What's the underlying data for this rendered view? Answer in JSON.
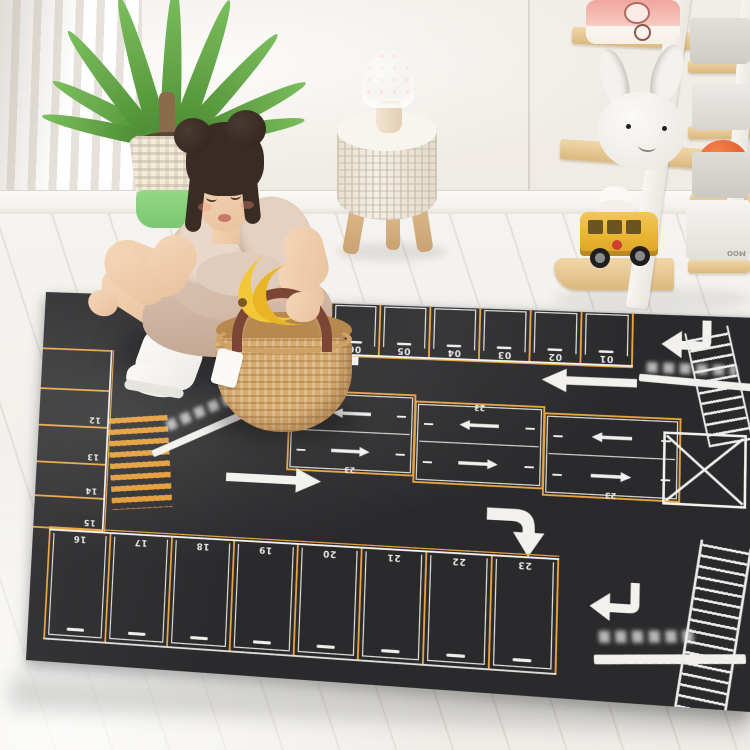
{
  "scene": {
    "mat": {
      "base_color": "#2a292b",
      "line_yellow": "#e8a33d",
      "line_white": "#f2f1ee",
      "zebra_color": "#e29a33",
      "top_bays": [
        "06",
        "05",
        "04",
        "03",
        "02",
        "01"
      ],
      "left_bays": [
        "12",
        "13",
        "14",
        "15"
      ],
      "bottom_bays": [
        "16",
        "17",
        "18",
        "19",
        "20",
        "21",
        "22",
        "23"
      ],
      "grid_labels": [
        "23",
        "23",
        "23"
      ],
      "blurred_signs": [
        "top-right-entrance",
        "center-left-road",
        "bottom-right-entrance"
      ]
    },
    "shelf": {
      "bin_text": "MOO",
      "wood_color": "#e8cb97",
      "bus_color": "#ecb93e",
      "ball_color": "#e86a38"
    },
    "lamp": {
      "cap_color": "#f3aac6"
    },
    "plant": {
      "pot_green_color": "#8ed37f"
    },
    "fruit": {
      "banana_color": "#f2c53a",
      "orange_color": "#f59b35"
    }
  }
}
